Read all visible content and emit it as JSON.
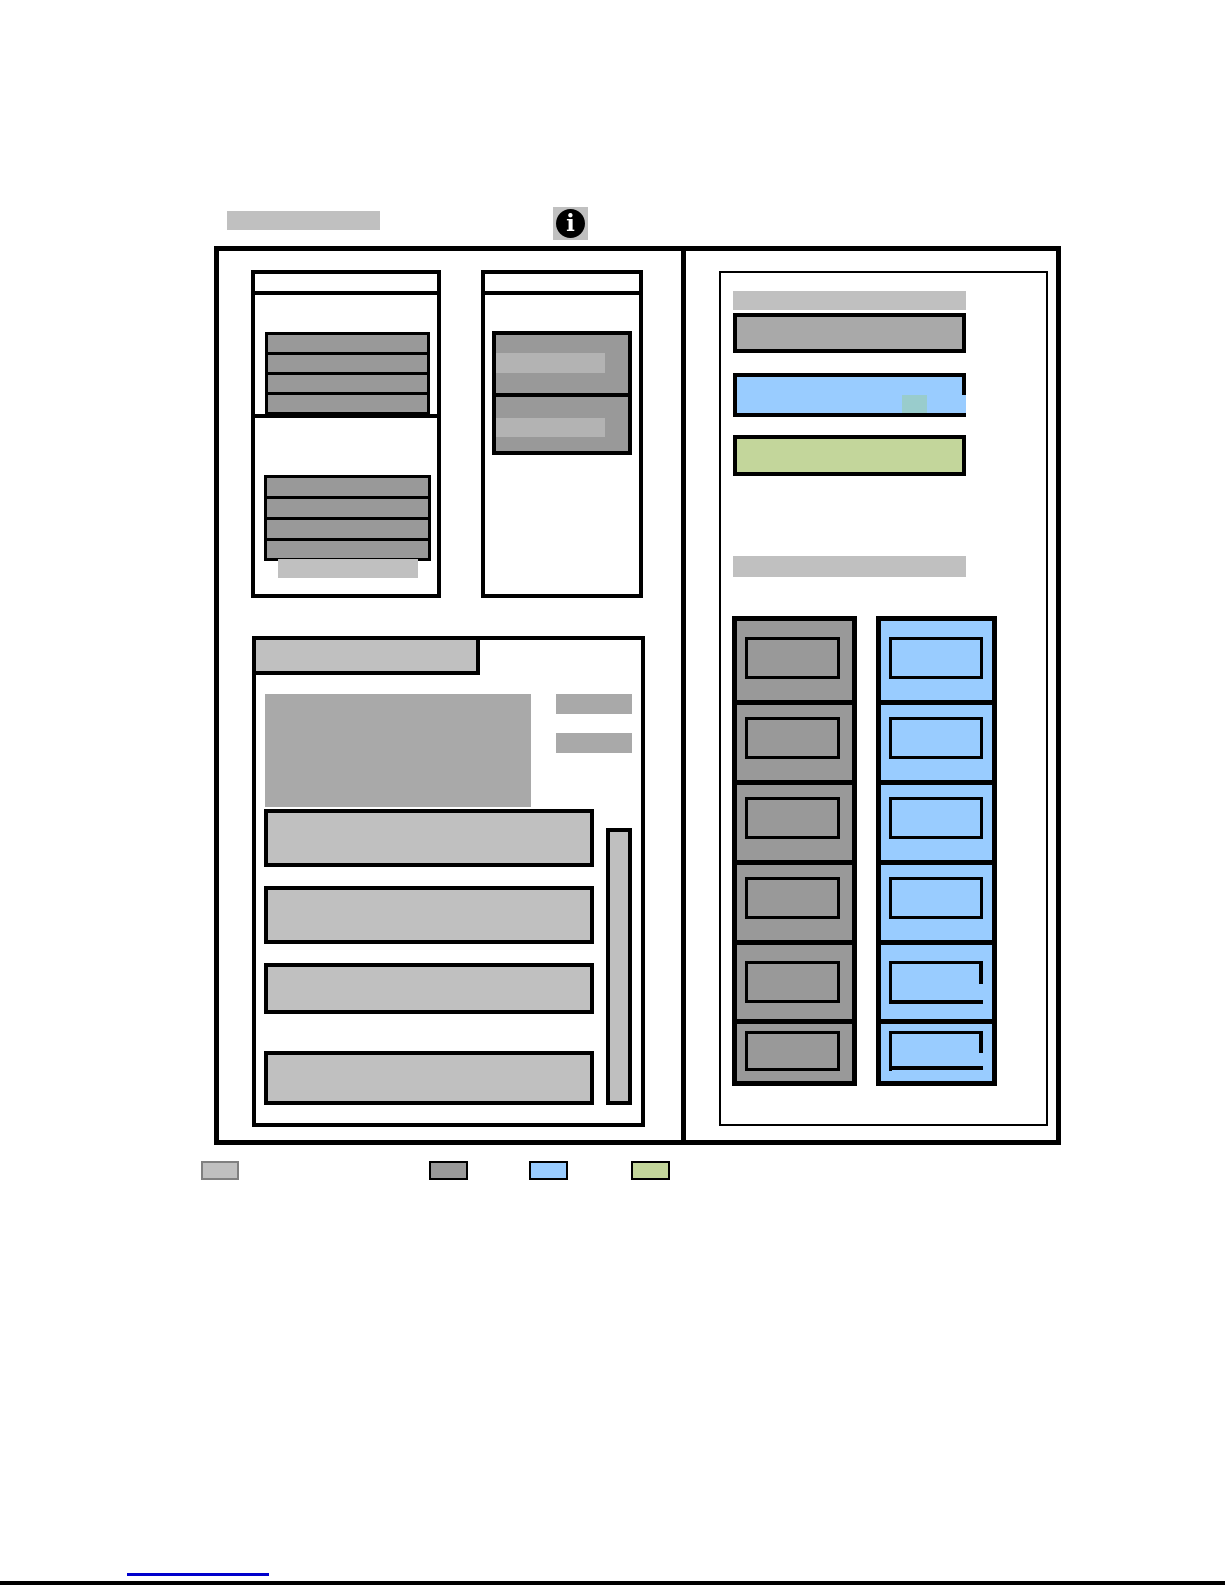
{
  "colors": {
    "ink": "#000000",
    "lightgray": "#c0c0c0",
    "midgray": "#999999",
    "gray2": "#a9a9a9",
    "innerbar": "#b3b3b3",
    "scroll": "#bfbfbf",
    "blue": "#99ccff",
    "teal": "#99cccc",
    "green": "#c3d69b",
    "link": "#0000cc",
    "border_gray": "#808080"
  },
  "info_icon": {
    "glyph": "i"
  },
  "figure": {
    "display_section": {
      "status_lines_top": 4,
      "status_lines_bottom": 4
    },
    "control_section": {
      "button_rows": 2
    },
    "message_section": {
      "rows": 4,
      "has_scrollbar": true
    },
    "settings_panel": {
      "bars": [
        "gray",
        "blue",
        "green"
      ],
      "has_selection_highlight": true,
      "slot_columns": {
        "gray_slots": 6,
        "blue_slots": 6,
        "open_blue_slots": 2
      }
    }
  },
  "legend": {
    "swatches": [
      {
        "name": "light-gray",
        "fill": "#c0c0c0",
        "border": "#808080"
      },
      {
        "name": "dark-gray",
        "fill": "#999999",
        "border": "#000000"
      },
      {
        "name": "blue",
        "fill": "#99ccff",
        "border": "#000000"
      },
      {
        "name": "green",
        "fill": "#c3d69b",
        "border": "#000000"
      }
    ]
  },
  "footer": {
    "link_underline_color": "#0000cc"
  }
}
